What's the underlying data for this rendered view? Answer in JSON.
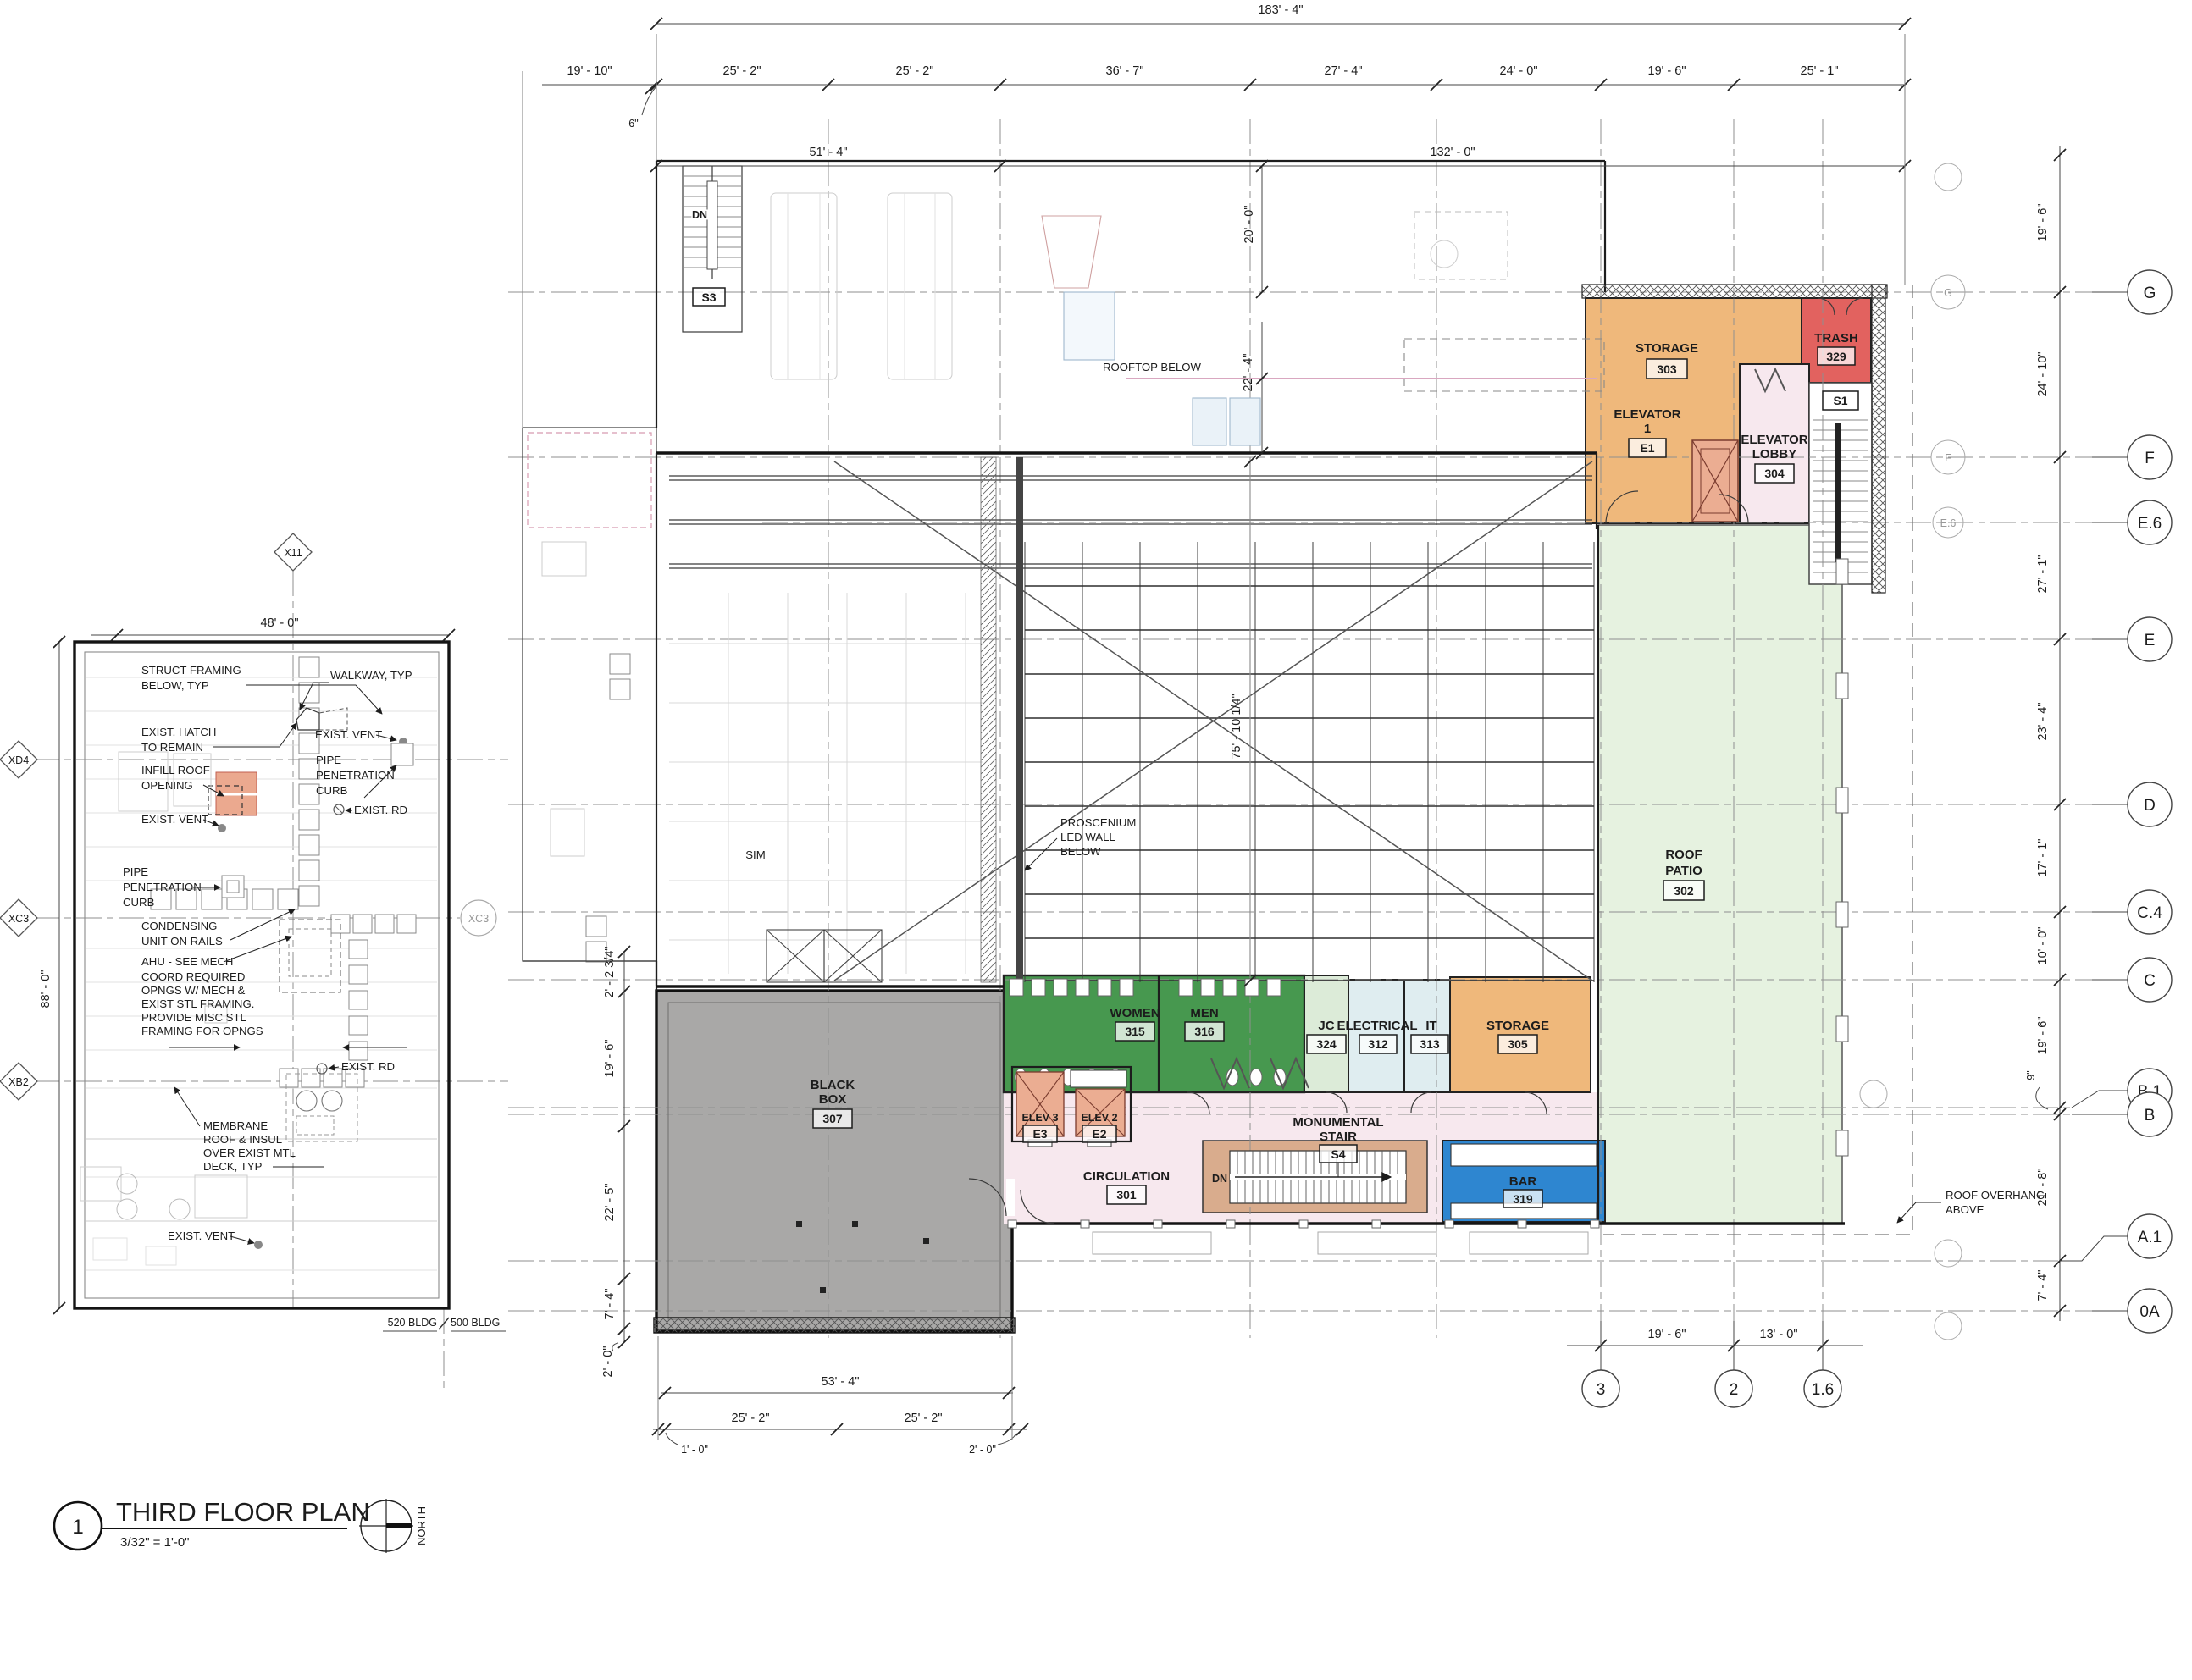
{
  "title": {
    "number": "1",
    "name": "THIRD FLOOR PLAN",
    "scale": "3/32\" = 1'-0\"",
    "north_label": "NORTH"
  },
  "colors": {
    "storage": "#EFB87B",
    "trash": "#E2625F",
    "pink": "#F7E8EE",
    "patio": "#E6F2E0",
    "restroom": "#47984F",
    "jc": "#DCEBD8",
    "elec": "#DFEDF0",
    "bar": "#2E86D0",
    "blackbox": "#A9A8A7",
    "stair_tan": "#D9AC8D",
    "shaft": "#EBAD92",
    "infill": "#EBA98F"
  },
  "dims": {
    "overall_top": "183' - 4\"",
    "top_row": [
      "19' - 10\"",
      "25' - 2\"",
      "25' - 2\"",
      "36' - 7\"",
      "27' - 4\"",
      "24' - 0\"",
      "19' - 6\"",
      "25' - 1\""
    ],
    "top_sub": [
      "51' - 4\"",
      "132' - 0\""
    ],
    "six_inch": "6\"",
    "right_col": [
      "19' - 6\"",
      "24' - 10\"",
      "27' - 1\"",
      "23' - 4\"",
      "17' - 1\"",
      "10' - 0\"",
      "19' - 6\"",
      "21' - 8\"",
      "7' - 4\""
    ],
    "nine_inch": "9\"",
    "bottom_grid": [
      "19' - 6\"",
      "13' - 0\""
    ],
    "blackbox_left": [
      "2' - 2 3/4\"",
      "19' - 6\"",
      "22' - 5\"",
      "7' - 4\"",
      "2' - 0\""
    ],
    "blackbox_bottom": [
      "53' - 4\"",
      "25' - 2\"",
      "25' - 2\""
    ],
    "blackbox_notes": [
      "1' - 0\"",
      "2' - 0\""
    ],
    "center": [
      "20' - 0\"",
      "22' - 4\"",
      "75' - 10 1/4\""
    ],
    "leftplan_width": "48' - 0\"",
    "leftplan_height": "88' - 0\""
  },
  "grids": {
    "right": [
      "G",
      "F",
      "E.6",
      "E",
      "D",
      "C.4",
      "C",
      "B.1",
      "B",
      "A.1",
      "0A"
    ],
    "right_small": [
      "G",
      "F",
      "E.6"
    ],
    "bottom": [
      "3",
      "2",
      "1.6"
    ],
    "left_diamonds": [
      "X11",
      "XD4",
      "XC3",
      "XB2"
    ],
    "xc3_circle": "XC3"
  },
  "rooms": {
    "storage303": {
      "name": "STORAGE",
      "number": "303"
    },
    "trash": {
      "name": "TRASH",
      "number": "329"
    },
    "elevator1": {
      "line1": "ELEVATOR",
      "line2": "1",
      "number": "E1"
    },
    "elevator_lobby": {
      "line1": "ELEVATOR",
      "line2": "LOBBY",
      "number": "304"
    },
    "stair_s1": "S1",
    "stair_s3": "S3",
    "roof_patio": {
      "line1": "ROOF",
      "line2": "PATIO",
      "number": "302"
    },
    "women": {
      "name": "WOMEN",
      "number": "315"
    },
    "men": {
      "name": "MEN",
      "number": "316"
    },
    "jc": {
      "name": "JC",
      "number": "324"
    },
    "electrical": {
      "name": "ELECTRICAL",
      "number": "312"
    },
    "it": {
      "name": "IT",
      "number": "313"
    },
    "storage305": {
      "name": "STORAGE",
      "number": "305"
    },
    "black_box": {
      "line1": "BLACK",
      "line2": "BOX",
      "number": "307"
    },
    "elev3": {
      "name": "ELEV 3",
      "number": "E3"
    },
    "elev2": {
      "name": "ELEV 2",
      "number": "E2"
    },
    "monumental_stair": {
      "line1": "MONUMENTAL",
      "line2": "STAIR",
      "number": "S4"
    },
    "circulation": {
      "name": "CIRCULATION",
      "number": "301"
    },
    "bar": {
      "name": "BAR",
      "number": "319"
    },
    "sim": "SIM",
    "dn_stair": "DN",
    "dn_top": "DN"
  },
  "annotations": {
    "struct_framing": [
      "STRUCT FRAMING",
      "BELOW, TYP"
    ],
    "walkway": "WALKWAY, TYP",
    "exist_hatch": [
      "EXIST. HATCH",
      "TO REMAIN"
    ],
    "exist_vent_a": "EXIST. VENT",
    "exist_vent_b": "EXIST. VENT",
    "exist_vent_c": "EXIST. VENT",
    "pipe_curb_a": [
      "PIPE",
      "PENETRATION",
      "CURB"
    ],
    "pipe_curb_b": [
      "PIPE",
      "PENETRATION",
      "CURB"
    ],
    "exist_rd_a": "EXIST. RD",
    "exist_rd_b": "EXIST. RD",
    "infill": [
      "INFILL ROOF",
      "OPENING"
    ],
    "condensing": [
      "CONDENSING",
      "UNIT ON RAILS"
    ],
    "ahu": "AHU - SEE MECH",
    "coord": [
      "COORD REQUIRED",
      "OPNGS W/ MECH &",
      "EXIST STL FRAMING.",
      "PROVIDE MISC STL",
      "FRAMING FOR OPNGS"
    ],
    "membrane": [
      "MEMBRANE",
      "ROOF & INSUL",
      "OVER EXIST MTL",
      "DECK, TYP"
    ],
    "rooftop_below": "ROOFTOP BELOW",
    "proscenium": [
      "PROSCENIUM",
      "LED WALL",
      "BELOW"
    ],
    "roof_overhang": [
      "ROOF OVERHANG",
      "ABOVE"
    ],
    "bldg_520": "520 BLDG",
    "bldg_500": "500 BLDG"
  }
}
